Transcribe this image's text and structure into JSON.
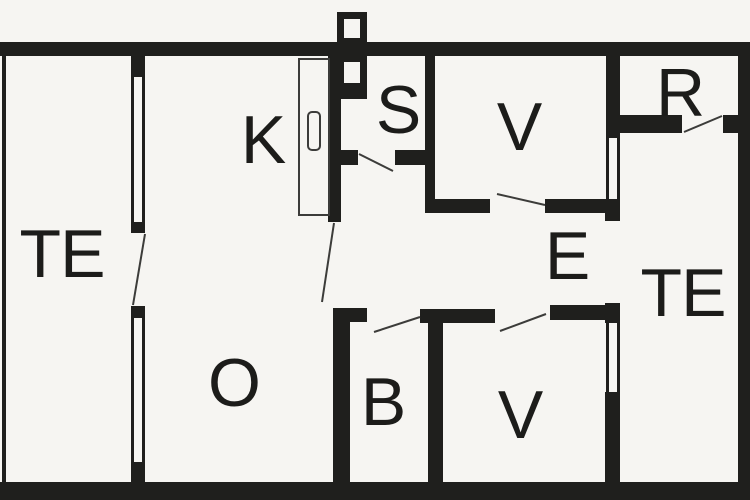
{
  "floor_plan": {
    "rooms": [
      {
        "key": "te-left",
        "label": "TE"
      },
      {
        "key": "k",
        "label": "K"
      },
      {
        "key": "s",
        "label": "S"
      },
      {
        "key": "v-top",
        "label": "V"
      },
      {
        "key": "r",
        "label": "R"
      },
      {
        "key": "e",
        "label": "E"
      },
      {
        "key": "te-right",
        "label": "TE"
      },
      {
        "key": "o",
        "label": "O"
      },
      {
        "key": "b",
        "label": "B"
      },
      {
        "key": "v-bottom",
        "label": "V"
      }
    ],
    "colors": {
      "wall": "#1f1f1d",
      "floor": "#f6f5f2",
      "label": "#1c1c1a",
      "line": "#3c3c3a"
    }
  }
}
